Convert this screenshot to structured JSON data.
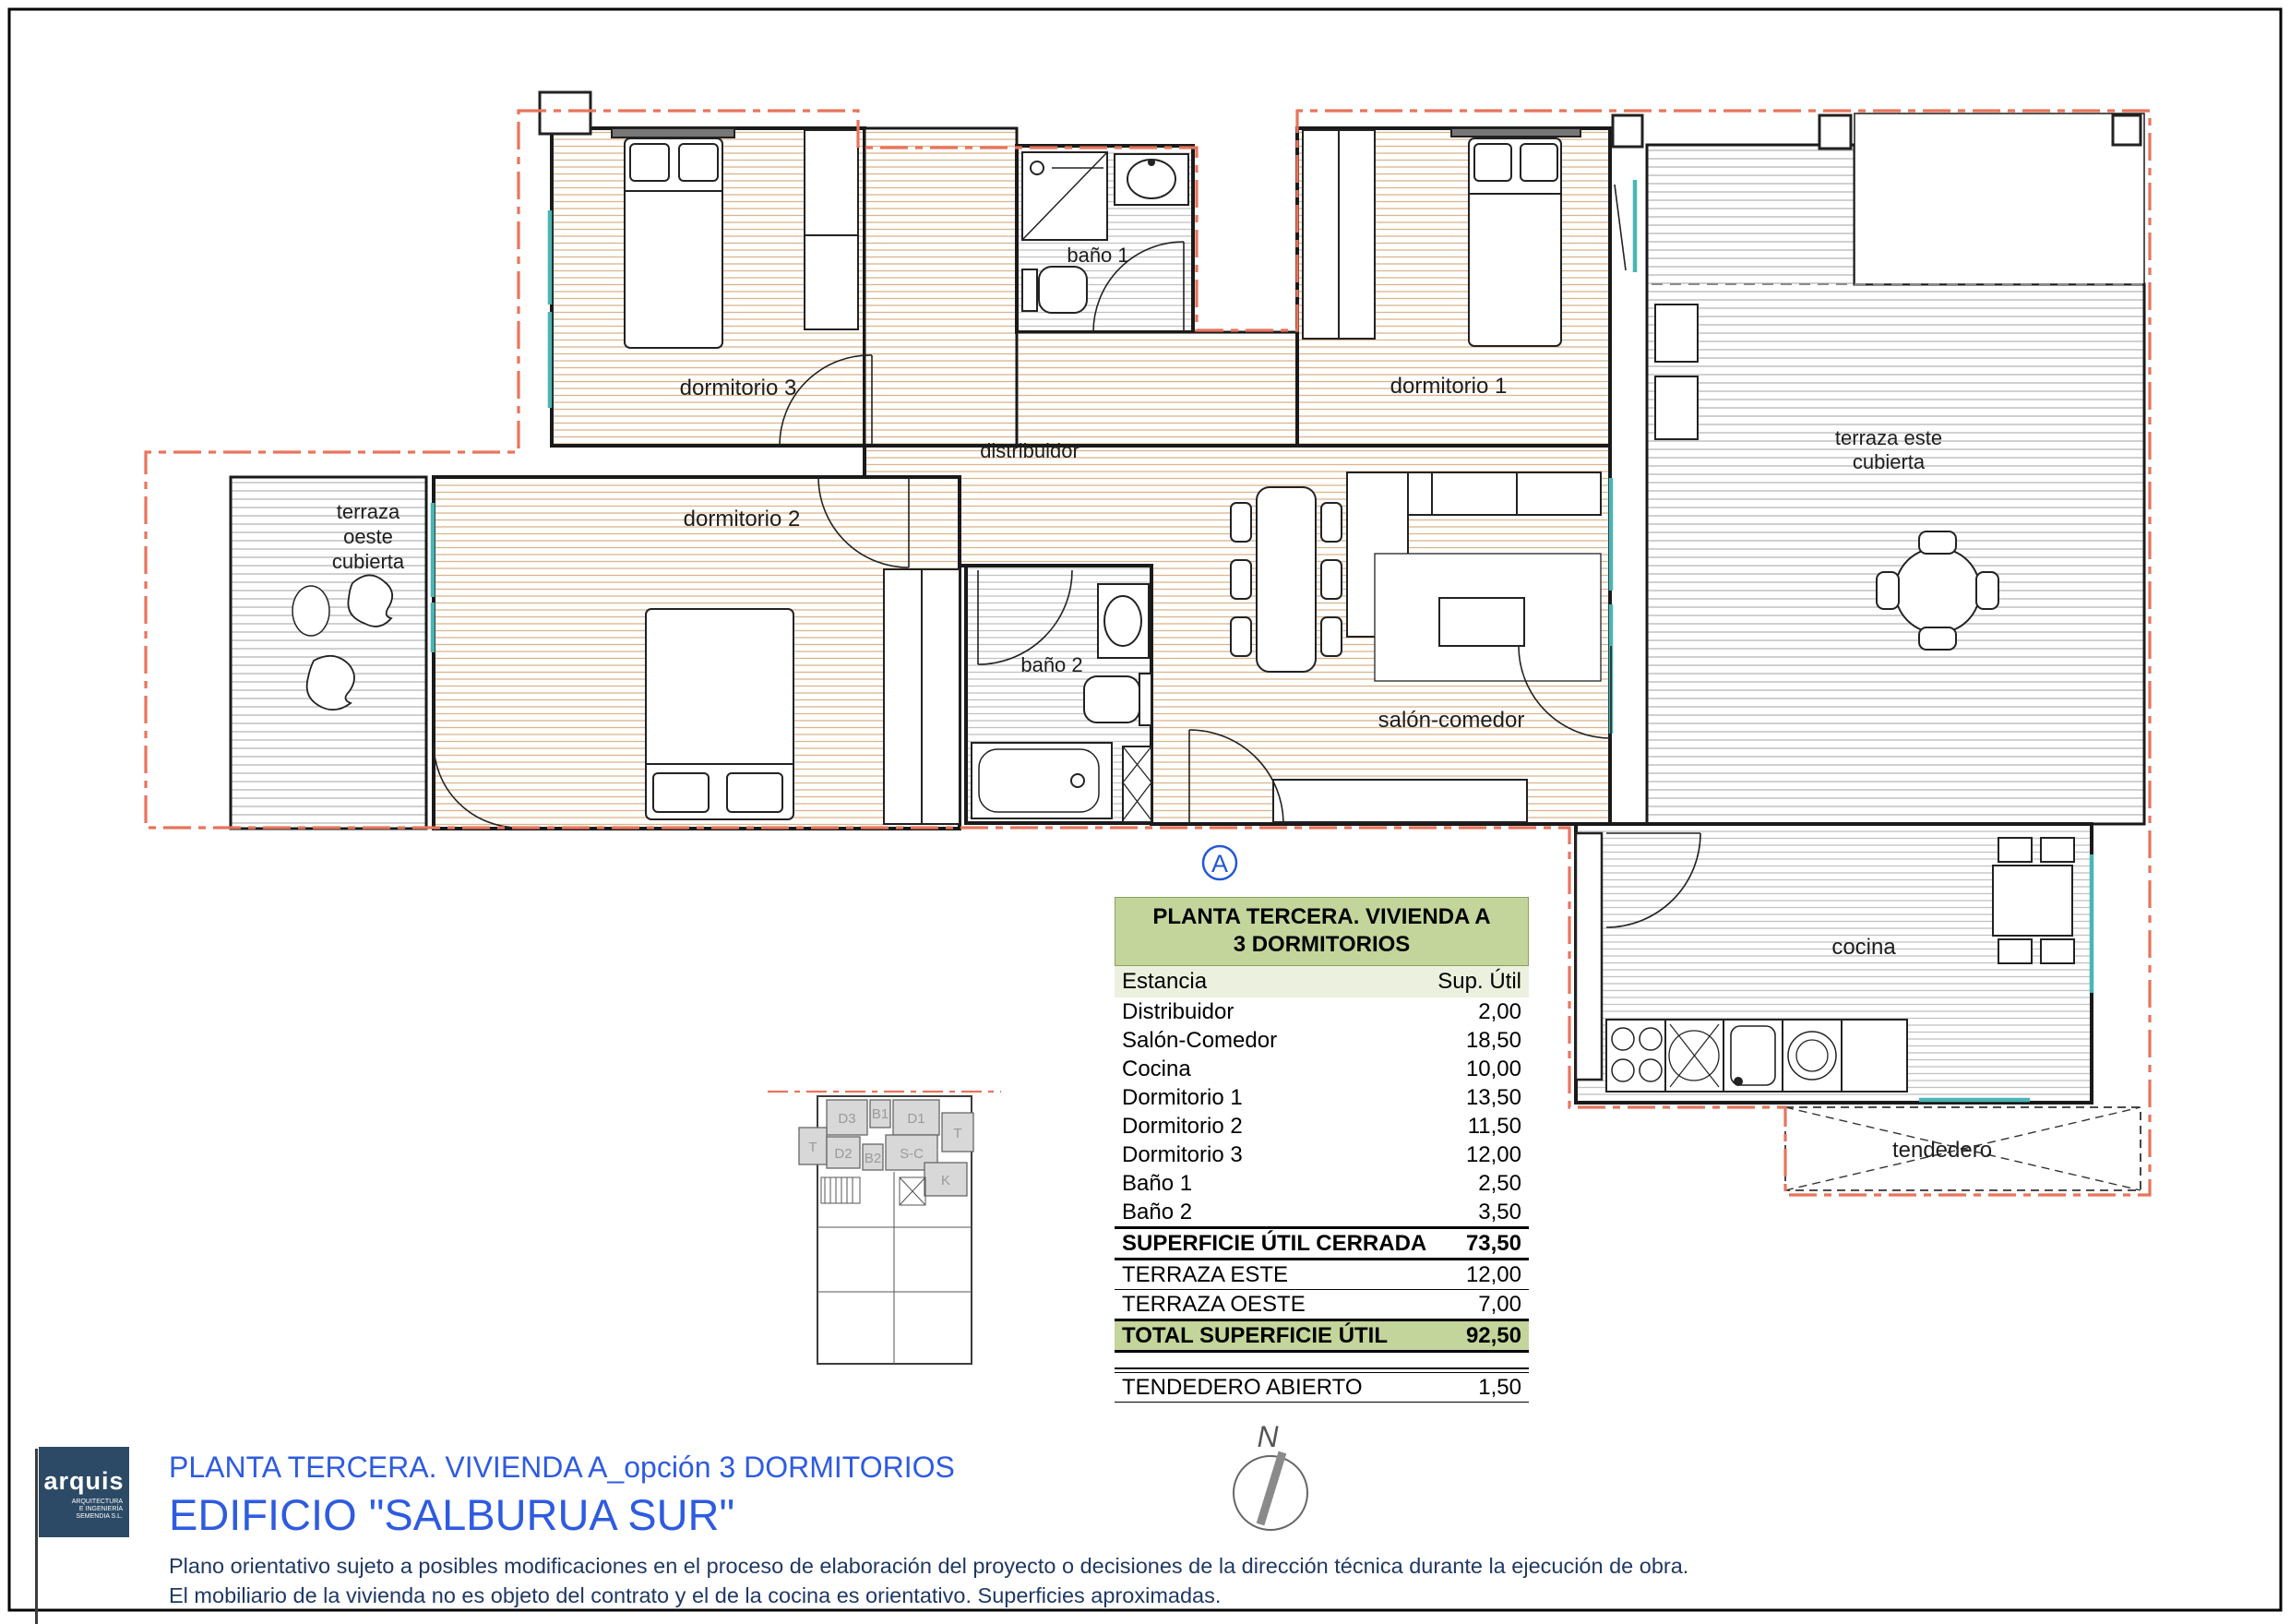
{
  "plan": {
    "rooms": {
      "dormitorio3": "dormitorio 3",
      "dormitorio1": "dormitorio 1",
      "dormitorio2": "dormitorio 2",
      "distribuidor": "distribuidor",
      "bano1": "baño 1",
      "bano2": "baño 2",
      "salon": "salón-comedor",
      "cocina": "cocina",
      "tendedero": "tendedero",
      "terraza_este_1": "terraza este",
      "terraza_este_2": "cubierta",
      "terraza_oeste_1": "terraza",
      "terraza_oeste_2": "oeste",
      "terraza_oeste_3": "cubierta"
    },
    "marker": "A",
    "compass": "N"
  },
  "keyplan": {
    "d3": "D3",
    "b1": "B1",
    "d1": "D1",
    "t_right": "T",
    "t_left": "T",
    "d2": "D2",
    "b2": "B2",
    "sc": "S-C",
    "k": "K"
  },
  "table": {
    "title_line1": "PLANTA TERCERA. VIVIENDA A",
    "title_line2": "3 DORMITORIOS",
    "col_room": "Estancia",
    "col_area": "Sup. Útil",
    "rows": [
      {
        "label": "Distribuidor",
        "value": "2,00"
      },
      {
        "label": "Salón-Comedor",
        "value": "18,50"
      },
      {
        "label": "Cocina",
        "value": "10,00"
      },
      {
        "label": "Dormitorio 1",
        "value": "13,50"
      },
      {
        "label": "Dormitorio 2",
        "value": "11,50"
      },
      {
        "label": "Dormitorio 3",
        "value": "12,00"
      },
      {
        "label": "Baño 1",
        "value": "2,50"
      },
      {
        "label": "Baño 2",
        "value": "3,50"
      }
    ],
    "subtotal": {
      "label": "SUPERFICIE ÚTIL CERRADA",
      "value": "73,50"
    },
    "terraza_este": {
      "label": "TERRAZA ESTE",
      "value": "12,00"
    },
    "terraza_oeste": {
      "label": "TERRAZA OESTE",
      "value": "7,00"
    },
    "total": {
      "label": "TOTAL SUPERFICIE ÚTIL",
      "value": "92,50"
    },
    "tendedero": {
      "label": "TENDEDERO ABIERTO",
      "value": "1,50"
    }
  },
  "titleblock": {
    "logo_text": "arquis",
    "logo_sub1": "ARQUITECTURA",
    "logo_sub2": "E INGENIERÍA",
    "logo_sub3": "SEMENDIA S.L.",
    "line1": "PLANTA TERCERA. VIVIENDA A_opción 3 DORMITORIOS",
    "line2": "EDIFICIO \"SALBURUA SUR\"",
    "disclaimer1": "Plano orientativo sujeto a posibles modificaciones en el proceso de elaboración del proyecto o decisiones de la dirección técnica durante la ejecución de obra.",
    "disclaimer2": "El mobiliario de la vivienda no es objeto del contrato y el de la cocina es orientativo. Superficies aproximadas."
  },
  "colors": {
    "boundary_red": "#e8745c",
    "window_teal": "#4ab5b5",
    "hatch_tan": "#dbb48c",
    "hatch_gray": "#c2c2c2",
    "table_green": "#c3d59b",
    "table_green_light": "#ebf1de",
    "title_blue": "#2e5be0",
    "navy": "#1f3864",
    "logo_navy": "#2c4a66"
  }
}
